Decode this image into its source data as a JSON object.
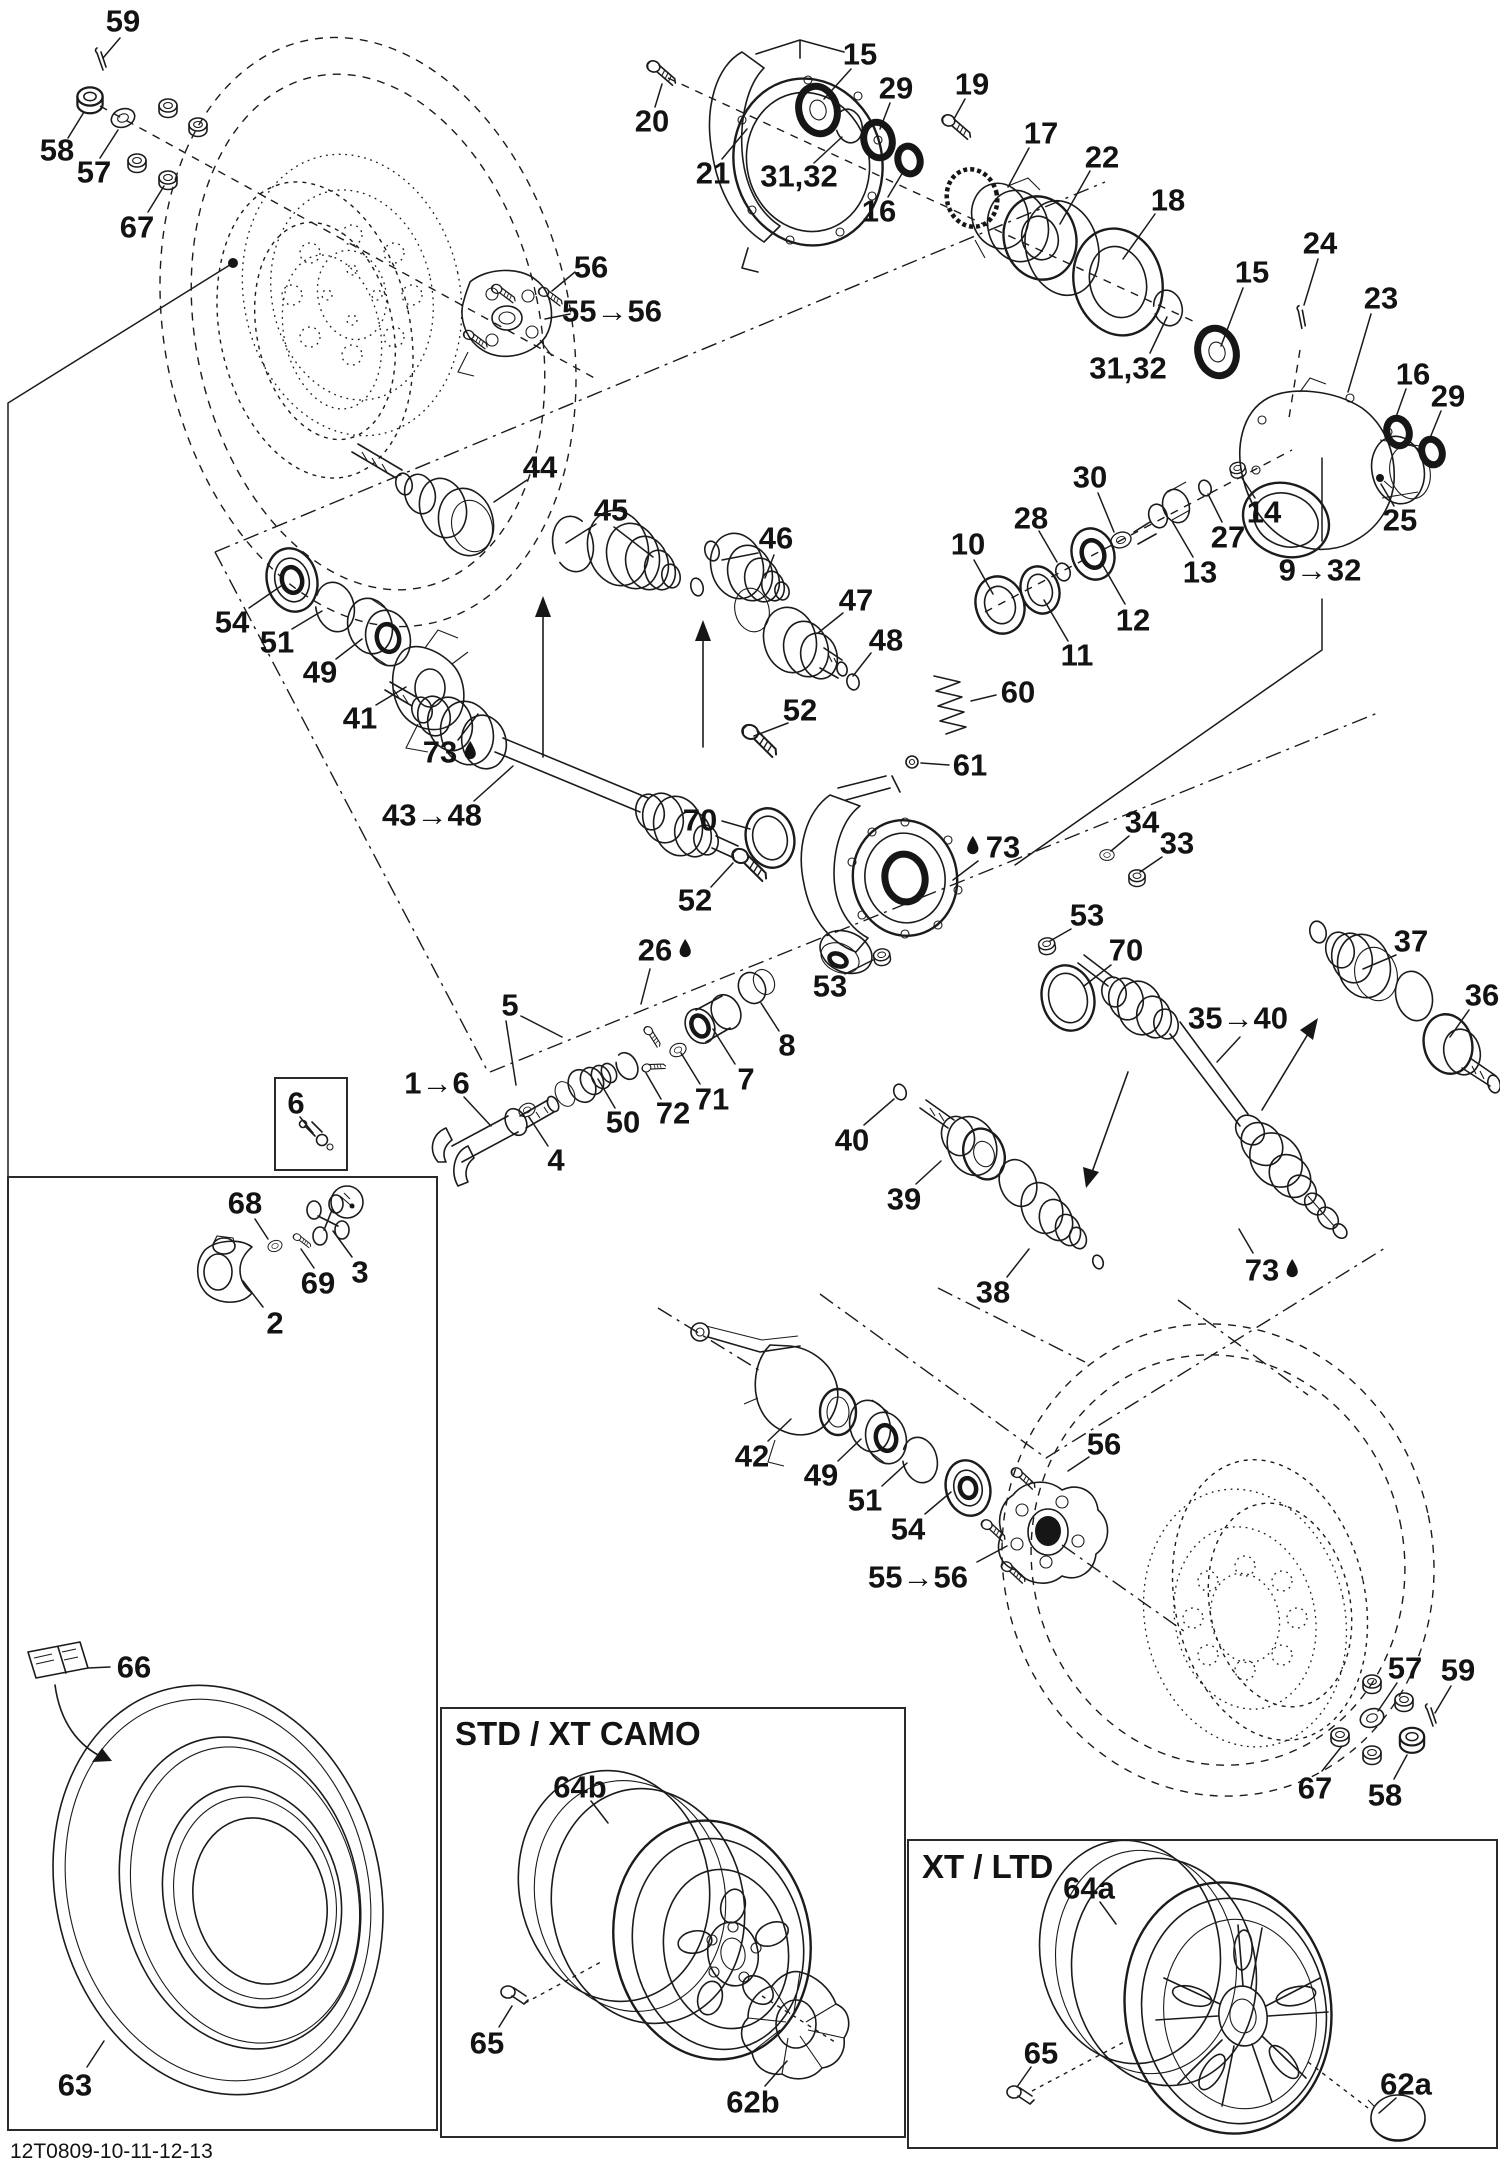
{
  "diagram": {
    "sheet_code": "12T0809-10-11-12-13",
    "accent_color": "#131313",
    "background_color": "#ffffff"
  },
  "boxes": {
    "std_camo": {
      "title": "STD / XT CAMO"
    },
    "xt_ltd": {
      "title": "XT / LTD"
    }
  },
  "icons": {
    "droplet": "oil-droplet-icon"
  },
  "labels": [
    {
      "id": "l59a",
      "text": "59",
      "x": 123,
      "y": 21
    },
    {
      "id": "l58a",
      "text": "58",
      "x": 57,
      "y": 150
    },
    {
      "id": "l57a",
      "text": "57",
      "x": 94,
      "y": 172
    },
    {
      "id": "l67a",
      "text": "67",
      "x": 137,
      "y": 227
    },
    {
      "id": "l56a",
      "text": "56",
      "x": 591,
      "y": 267
    },
    {
      "id": "l55_56a",
      "text": "55→56",
      "x": 612,
      "y": 311
    },
    {
      "id": "l20",
      "text": "20",
      "x": 652,
      "y": 121
    },
    {
      "id": "l21",
      "text": "21",
      "x": 713,
      "y": 173
    },
    {
      "id": "l15a",
      "text": "15",
      "x": 860,
      "y": 54
    },
    {
      "id": "l3132a",
      "text": "31,32",
      "x": 799,
      "y": 176
    },
    {
      "id": "l16a",
      "text": "16",
      "x": 879,
      "y": 211
    },
    {
      "id": "l29a",
      "text": "29",
      "x": 896,
      "y": 88
    },
    {
      "id": "l19",
      "text": "19",
      "x": 972,
      "y": 84
    },
    {
      "id": "l17",
      "text": "17",
      "x": 1041,
      "y": 133
    },
    {
      "id": "l22",
      "text": "22",
      "x": 1102,
      "y": 157
    },
    {
      "id": "l18",
      "text": "18",
      "x": 1168,
      "y": 200
    },
    {
      "id": "l24",
      "text": "24",
      "x": 1320,
      "y": 243
    },
    {
      "id": "l15b",
      "text": "15",
      "x": 1252,
      "y": 272
    },
    {
      "id": "l23",
      "text": "23",
      "x": 1381,
      "y": 298
    },
    {
      "id": "l3132b",
      "text": "31,32",
      "x": 1128,
      "y": 368
    },
    {
      "id": "l16b",
      "text": "16",
      "x": 1413,
      "y": 374
    },
    {
      "id": "l29b",
      "text": "29",
      "x": 1448,
      "y": 396
    },
    {
      "id": "l25",
      "text": "25",
      "x": 1400,
      "y": 520
    },
    {
      "id": "l9_32",
      "text": "9→32",
      "x": 1320,
      "y": 570
    },
    {
      "id": "l14",
      "text": "14",
      "x": 1264,
      "y": 512
    },
    {
      "id": "l27",
      "text": "27",
      "x": 1228,
      "y": 537
    },
    {
      "id": "l30",
      "text": "30",
      "x": 1090,
      "y": 477
    },
    {
      "id": "l13",
      "text": "13",
      "x": 1200,
      "y": 572
    },
    {
      "id": "l12",
      "text": "12",
      "x": 1133,
      "y": 620
    },
    {
      "id": "l28",
      "text": "28",
      "x": 1031,
      "y": 518
    },
    {
      "id": "l10",
      "text": "10",
      "x": 968,
      "y": 544
    },
    {
      "id": "l11",
      "text": "11",
      "x": 1077,
      "y": 655
    },
    {
      "id": "l44",
      "text": "44",
      "x": 540,
      "y": 467
    },
    {
      "id": "l45",
      "text": "45",
      "x": 611,
      "y": 510
    },
    {
      "id": "l46",
      "text": "46",
      "x": 776,
      "y": 538
    },
    {
      "id": "l47",
      "text": "47",
      "x": 856,
      "y": 600
    },
    {
      "id": "l48a",
      "text": "48",
      "x": 886,
      "y": 640
    },
    {
      "id": "l54a",
      "text": "54",
      "x": 232,
      "y": 622
    },
    {
      "id": "l51a",
      "text": "51",
      "x": 277,
      "y": 642
    },
    {
      "id": "l49a",
      "text": "49",
      "x": 320,
      "y": 672
    },
    {
      "id": "l41",
      "text": "41",
      "x": 360,
      "y": 718
    },
    {
      "id": "l73a",
      "text": "73",
      "x": 440,
      "y": 752,
      "droplet": "after"
    },
    {
      "id": "l43_48",
      "text": "43→48",
      "x": 432,
      "y": 815
    },
    {
      "id": "l70a",
      "text": "70",
      "x": 700,
      "y": 820
    },
    {
      "id": "l52a",
      "text": "52",
      "x": 800,
      "y": 710
    },
    {
      "id": "l60",
      "text": "60",
      "x": 1018,
      "y": 692
    },
    {
      "id": "l61",
      "text": "61",
      "x": 970,
      "y": 765
    },
    {
      "id": "l52b",
      "text": "52",
      "x": 695,
      "y": 900
    },
    {
      "id": "l73b",
      "text": "73",
      "x": 1003,
      "y": 847,
      "droplet": "before"
    },
    {
      "id": "l34",
      "text": "34",
      "x": 1142,
      "y": 822
    },
    {
      "id": "l33",
      "text": "33",
      "x": 1177,
      "y": 843
    },
    {
      "id": "l53a",
      "text": "53",
      "x": 1087,
      "y": 915
    },
    {
      "id": "l70b",
      "text": "70",
      "x": 1126,
      "y": 950
    },
    {
      "id": "l53b",
      "text": "53",
      "x": 830,
      "y": 986
    },
    {
      "id": "l26",
      "text": "26",
      "x": 655,
      "y": 950,
      "droplet": "after"
    },
    {
      "id": "l8",
      "text": "8",
      "x": 787,
      "y": 1045
    },
    {
      "id": "l7",
      "text": "7",
      "x": 746,
      "y": 1079
    },
    {
      "id": "l71",
      "text": "71",
      "x": 712,
      "y": 1099
    },
    {
      "id": "l72",
      "text": "72",
      "x": 673,
      "y": 1113
    },
    {
      "id": "l5",
      "text": "5",
      "x": 510,
      "y": 1005
    },
    {
      "id": "l50",
      "text": "50",
      "x": 623,
      "y": 1122
    },
    {
      "id": "l1_6",
      "text": "1→6",
      "x": 437,
      "y": 1083
    },
    {
      "id": "l4",
      "text": "4",
      "x": 556,
      "y": 1160
    },
    {
      "id": "l6",
      "text": "6",
      "x": 296,
      "y": 1103
    },
    {
      "id": "l68",
      "text": "68",
      "x": 245,
      "y": 1203
    },
    {
      "id": "l69",
      "text": "69",
      "x": 318,
      "y": 1283
    },
    {
      "id": "l3",
      "text": "3",
      "x": 360,
      "y": 1272
    },
    {
      "id": "l2",
      "text": "2",
      "x": 275,
      "y": 1323
    },
    {
      "id": "l37",
      "text": "37",
      "x": 1411,
      "y": 941
    },
    {
      "id": "l36",
      "text": "36",
      "x": 1482,
      "y": 995
    },
    {
      "id": "l35_40",
      "text": "35→40",
      "x": 1238,
      "y": 1018
    },
    {
      "id": "l40",
      "text": "40",
      "x": 852,
      "y": 1140
    },
    {
      "id": "l39",
      "text": "39",
      "x": 904,
      "y": 1199
    },
    {
      "id": "l38",
      "text": "38",
      "x": 993,
      "y": 1292
    },
    {
      "id": "l73c",
      "text": "73",
      "x": 1262,
      "y": 1270,
      "droplet": "after"
    },
    {
      "id": "l42",
      "text": "42",
      "x": 752,
      "y": 1456
    },
    {
      "id": "l49b",
      "text": "49",
      "x": 821,
      "y": 1475
    },
    {
      "id": "l51b",
      "text": "51",
      "x": 865,
      "y": 1500
    },
    {
      "id": "l54b",
      "text": "54",
      "x": 908,
      "y": 1529
    },
    {
      "id": "l56b",
      "text": "56",
      "x": 1104,
      "y": 1444
    },
    {
      "id": "l55_56b",
      "text": "55→56",
      "x": 918,
      "y": 1577
    },
    {
      "id": "l57b",
      "text": "57",
      "x": 1405,
      "y": 1668
    },
    {
      "id": "l59b",
      "text": "59",
      "x": 1458,
      "y": 1670
    },
    {
      "id": "l67b",
      "text": "67",
      "x": 1315,
      "y": 1788
    },
    {
      "id": "l58b",
      "text": "58",
      "x": 1385,
      "y": 1795
    },
    {
      "id": "l66",
      "text": "66",
      "x": 134,
      "y": 1667
    },
    {
      "id": "l63",
      "text": "63",
      "x": 75,
      "y": 2085
    },
    {
      "id": "l64b",
      "text": "64b",
      "x": 580,
      "y": 1787
    },
    {
      "id": "l65a",
      "text": "65",
      "x": 487,
      "y": 2043
    },
    {
      "id": "l62b",
      "text": "62b",
      "x": 753,
      "y": 2102
    },
    {
      "id": "l64a",
      "text": "64a",
      "x": 1089,
      "y": 1888
    },
    {
      "id": "l65b",
      "text": "65",
      "x": 1041,
      "y": 2053
    },
    {
      "id": "l62a",
      "text": "62a",
      "x": 1406,
      "y": 2084
    }
  ]
}
